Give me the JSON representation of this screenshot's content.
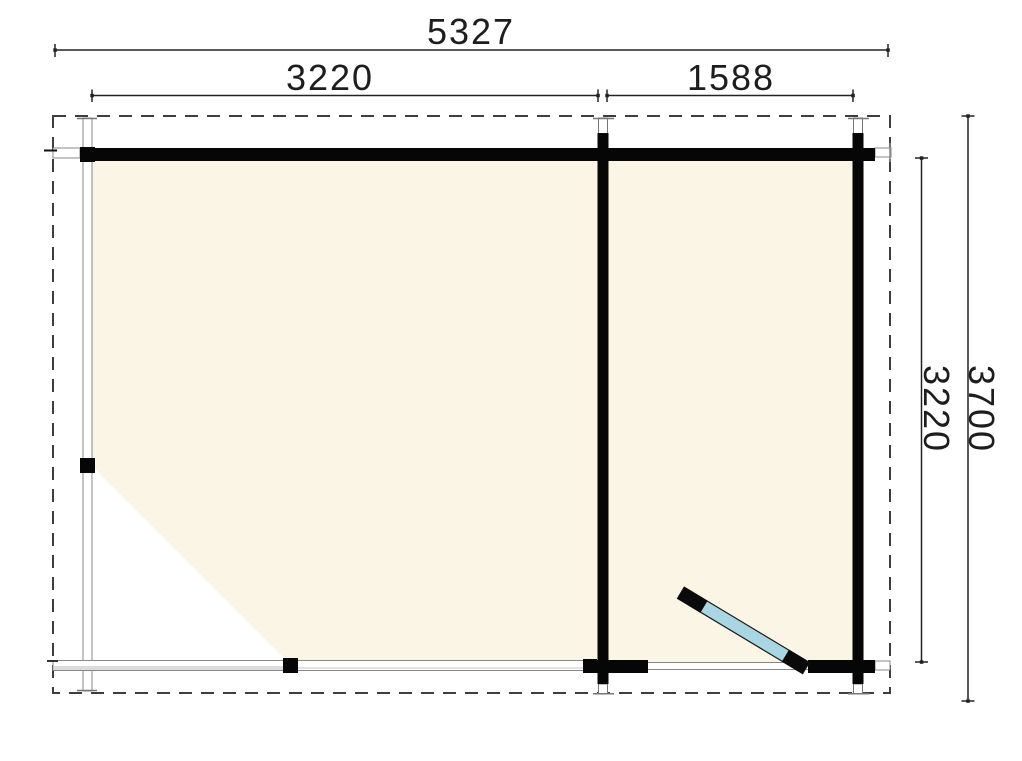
{
  "drawing": {
    "type": "floor-plan",
    "description": "Log cabin floor plan with open veranda (left, diagonal-cut deck), enclosed room (right) and hinged front door shown open",
    "background": "#ffffff"
  },
  "dimensions": {
    "total_width": "5327",
    "section_left_width": "3220",
    "section_right_width": "1588",
    "total_depth": "3700",
    "inner_depth": "3220"
  },
  "colors": {
    "floor_fill": "#fbf5e6",
    "wall": "#060606",
    "door_leaf": "#a8d6e2",
    "roof_outline_dash": "#3e3e3e",
    "thin_line": "#888888",
    "deck_band": "#dcdcdc",
    "dimension_line": "#222222",
    "dimension_text": "#1d1d1d"
  }
}
